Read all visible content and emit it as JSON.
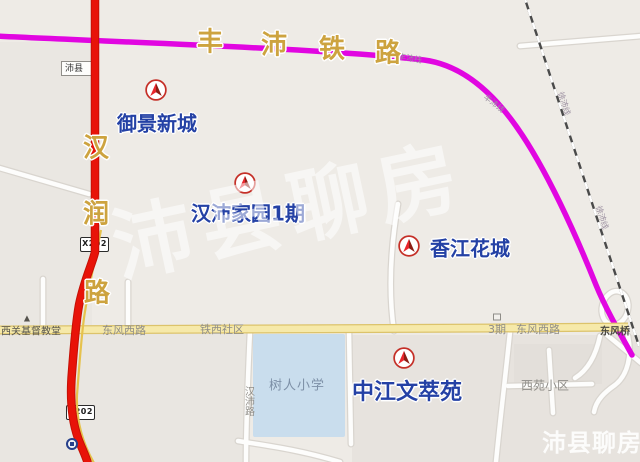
{
  "watermark": {
    "text": "沛县聊房",
    "corner_text": "沛县聊房"
  },
  "railway": {
    "name_chars": [
      "丰",
      "沛",
      "铁",
      "路"
    ],
    "fengpei_line_label": "丰沛线",
    "xupei_line_label": "徐沛线"
  },
  "roads": {
    "hanrun_chars": [
      "汉",
      "润",
      "路"
    ],
    "shield": "X202",
    "dongfeng_west": "东风西路",
    "tiexi_shequ": "铁西社区",
    "phase3": "3期",
    "dongfeng_bridge": "东风桥",
    "hanpei_lu": "汉沛路"
  },
  "places": {
    "peixian": "沛县",
    "church": "西关基督教堂",
    "school": "树人小学",
    "xiyuan": "西苑小区"
  },
  "estates": [
    {
      "name": "御景新城"
    },
    {
      "name": "汉沛家园1期"
    },
    {
      "name": "香江花城"
    },
    {
      "name": "中江文萃苑"
    }
  ],
  "colors": {
    "railway": "#e106e1",
    "main_road": "#e81309",
    "yellow_road": "#f6e9a9",
    "gold_text": "#cda33f",
    "estate_text": "#2441a5",
    "school_fill": "#c9dded"
  }
}
